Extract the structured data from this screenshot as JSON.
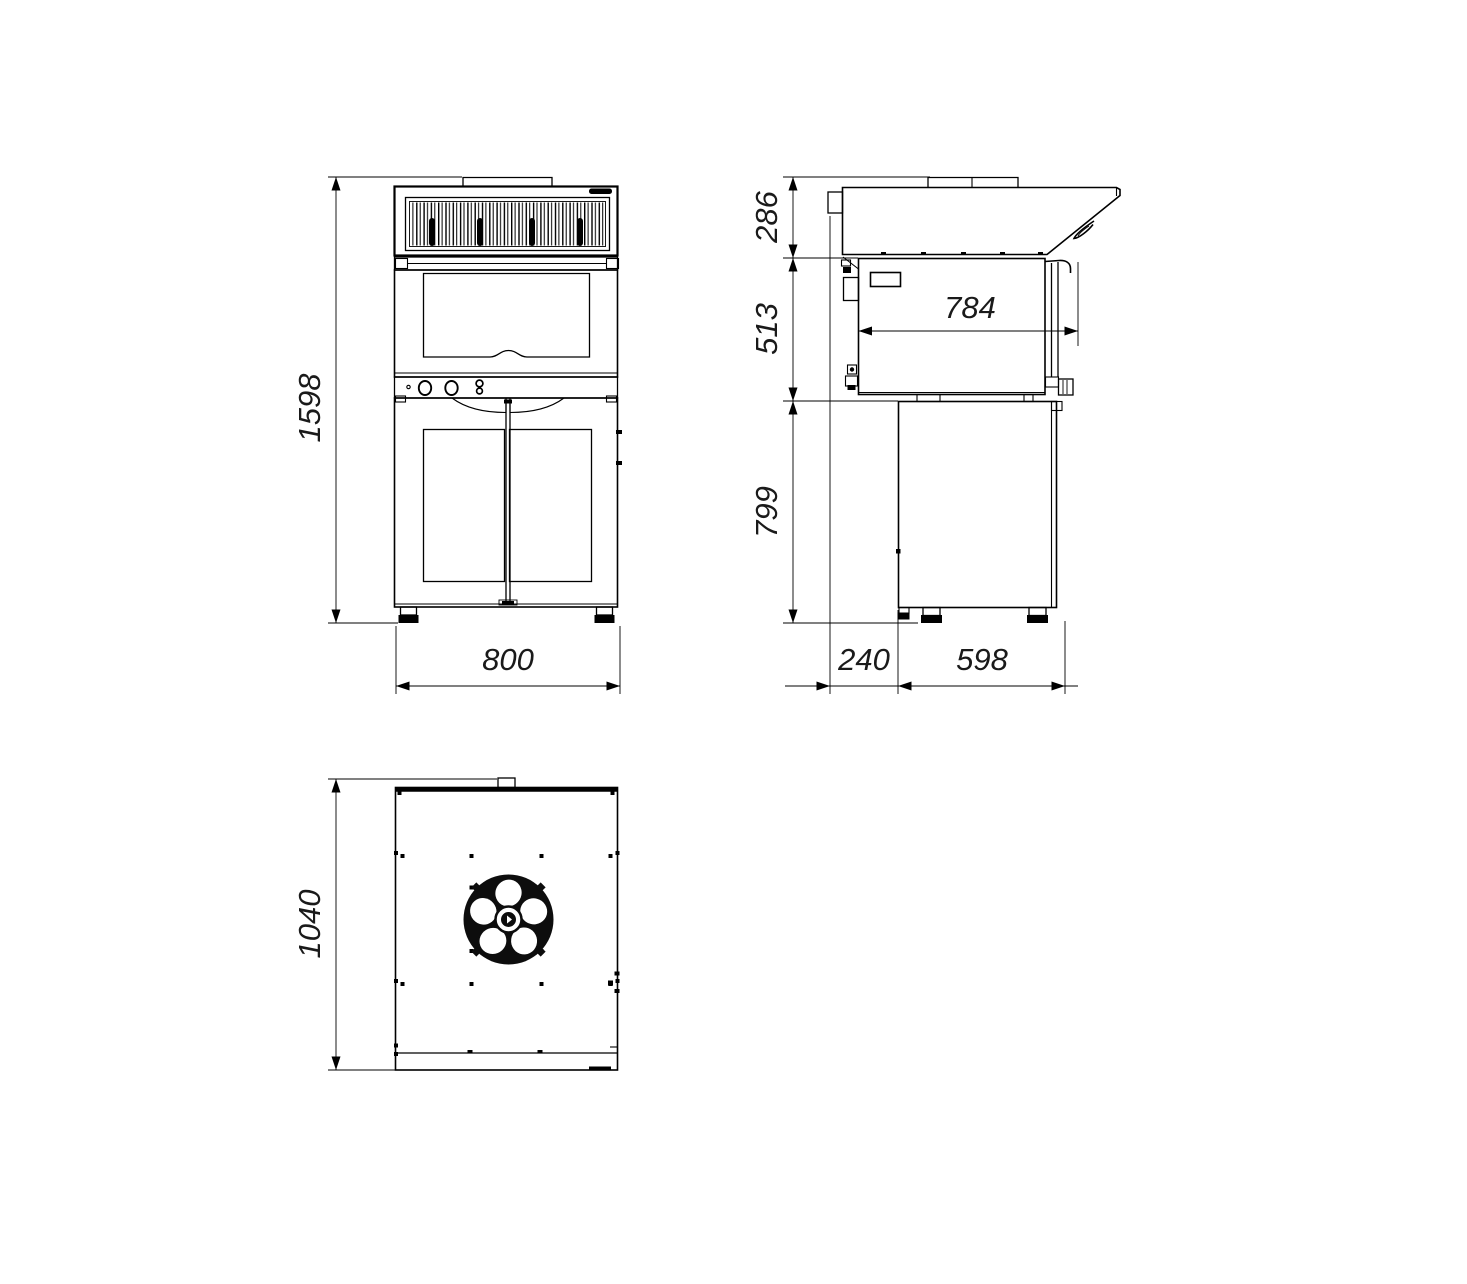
{
  "drawing": {
    "units": "mm",
    "dims": {
      "front_height": "1598",
      "front_width": "800",
      "hood_height": "286",
      "oven_height": "513",
      "stand_height": "799",
      "oven_depth": "784",
      "rear_offset": "240",
      "stand_depth": "598",
      "top_depth": "1040"
    },
    "colors": {
      "line": "#000000",
      "background": "#ffffff",
      "dim_text": "#1a1a1a"
    }
  }
}
